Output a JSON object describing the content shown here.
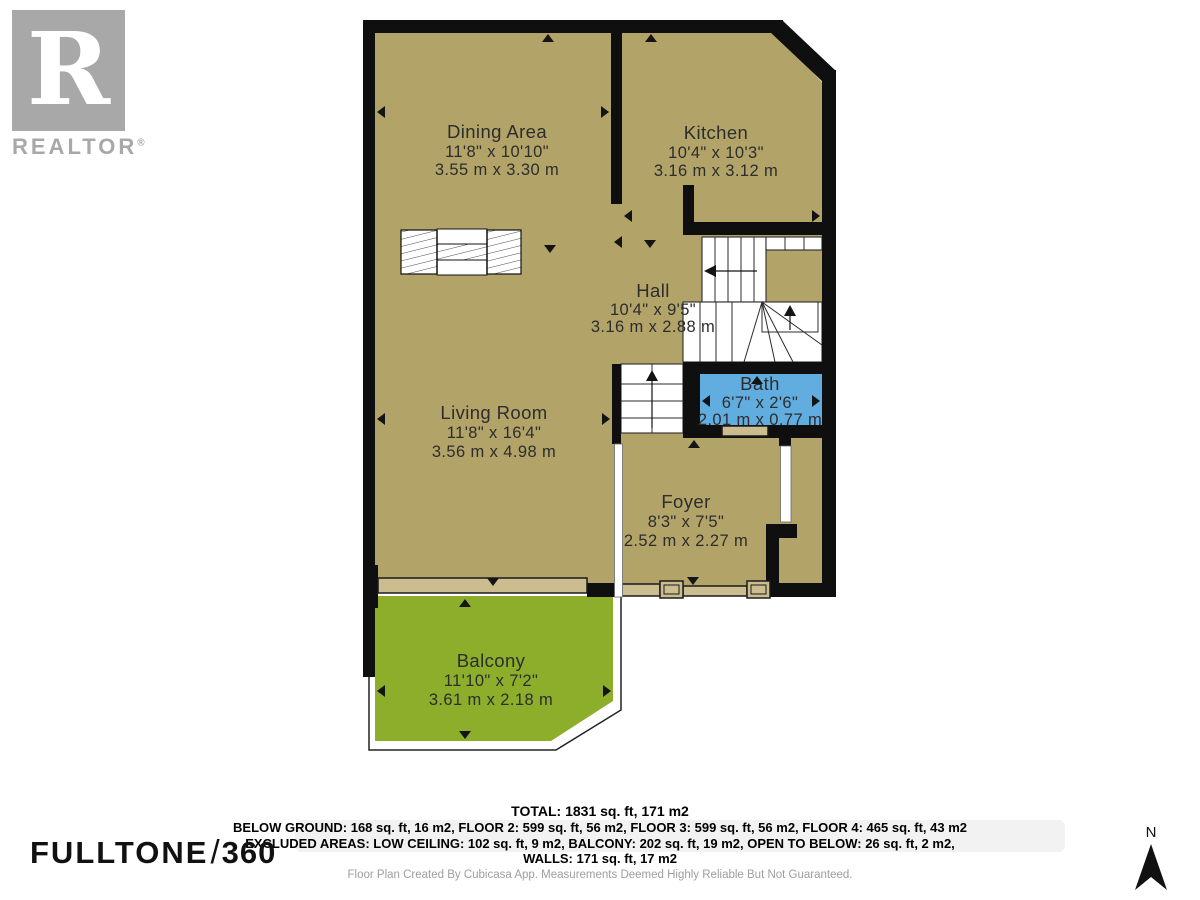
{
  "branding": {
    "realtor_r": "R",
    "realtor_text": "REALTOR",
    "registered": "®",
    "fulltone": "FULLTONE",
    "slash": "/",
    "threesixty": "360"
  },
  "compass": {
    "label": "N"
  },
  "rooms": [
    {
      "name": "Dining Area",
      "imperial": "11'8\" x 10'10\"",
      "metric": "3.55 m x 3.30 m"
    },
    {
      "name": "Kitchen",
      "imperial": "10'4\" x 10'3\"",
      "metric": "3.16 m x 3.12 m"
    },
    {
      "name": "Hall",
      "imperial": "10'4\" x 9'5\"",
      "metric": "3.16 m x 2.88 m"
    },
    {
      "name": "Bath",
      "imperial": "6'7\" x 2'6\"",
      "metric": "2.01 m x 0.77 m"
    },
    {
      "name": "Living Room",
      "imperial": "11'8\" x 16'4\"",
      "metric": "3.56 m x 4.98 m"
    },
    {
      "name": "Foyer",
      "imperial": "8'3\" x 7'5\"",
      "metric": "2.52 m x 2.27 m"
    },
    {
      "name": "Balcony",
      "imperial": "11'10\" x 7'2\"",
      "metric": "3.61 m x 2.18 m"
    }
  ],
  "summary": {
    "total": "TOTAL: 1831 sq. ft, 171 m2",
    "floors": "BELOW GROUND: 168 sq. ft, 16 m2, FLOOR 2: 599 sq. ft, 56 m2, FLOOR 3: 599 sq. ft, 56 m2, FLOOR 4: 465 sq. ft, 43 m2",
    "excluded": "EXCLUDED AREAS: LOW CEILING: 102 sq. ft, 9 m2, BALCONY: 202 sq. ft, 19 m2, OPEN TO BELOW: 26 sq. ft, 2 m2,",
    "walls": "WALLS: 171 sq. ft, 17 m2"
  },
  "attribution": "Floor Plan Created By Cubicasa App. Measurements Deemed Highly Reliable But Not Guaranteed.",
  "colors": {
    "room": "#b2a368",
    "balcony": "#8cae2b",
    "bath": "#61ade0",
    "wall": "#0f0f0f",
    "door": "#ccbd90"
  }
}
